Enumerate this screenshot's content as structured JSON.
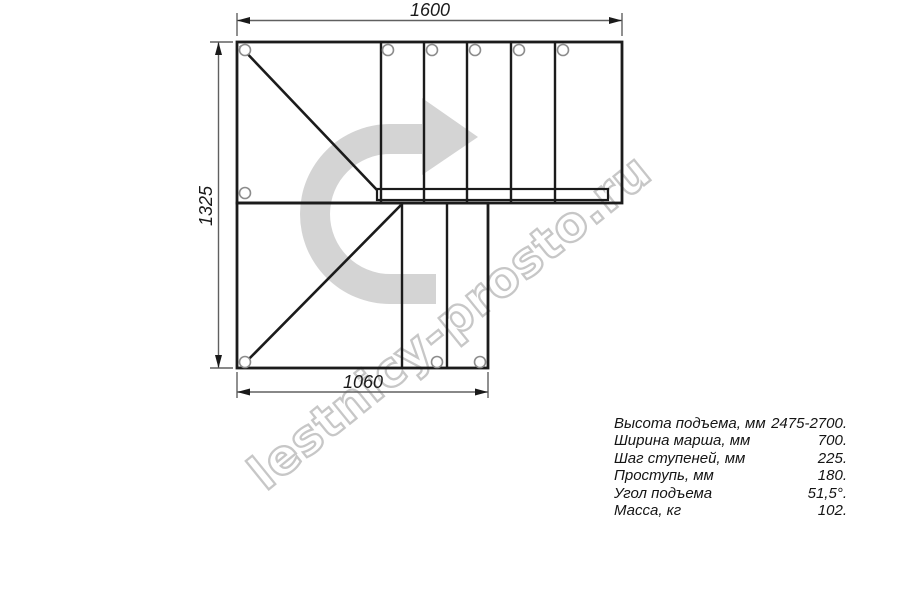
{
  "watermark": {
    "text": "lestnicy-prosto.ru"
  },
  "dimensions": {
    "top_width": "1600",
    "left_height": "1325",
    "bottom_width": "1060"
  },
  "specs": {
    "rows": [
      {
        "label": "Высота подъема, мм",
        "value": "2475-2700."
      },
      {
        "label": "Ширина марша, мм",
        "value": "700."
      },
      {
        "label": "Шаг ступеней, мм",
        "value": "225."
      },
      {
        "label": "Проступь, мм",
        "value": "180."
      },
      {
        "label": "Угол подъема",
        "value": "51,5°."
      },
      {
        "label": "Масса, кг",
        "value": "102."
      }
    ]
  },
  "icons": {
    "direction_arrow": "u-turn-right-arrow"
  },
  "colors": {
    "line": "#1b1b1b",
    "dimension_line": "#606060",
    "arrow_fill": "#d4d4d4",
    "watermark_stroke": "#c7c7c7",
    "background": "#ffffff"
  }
}
